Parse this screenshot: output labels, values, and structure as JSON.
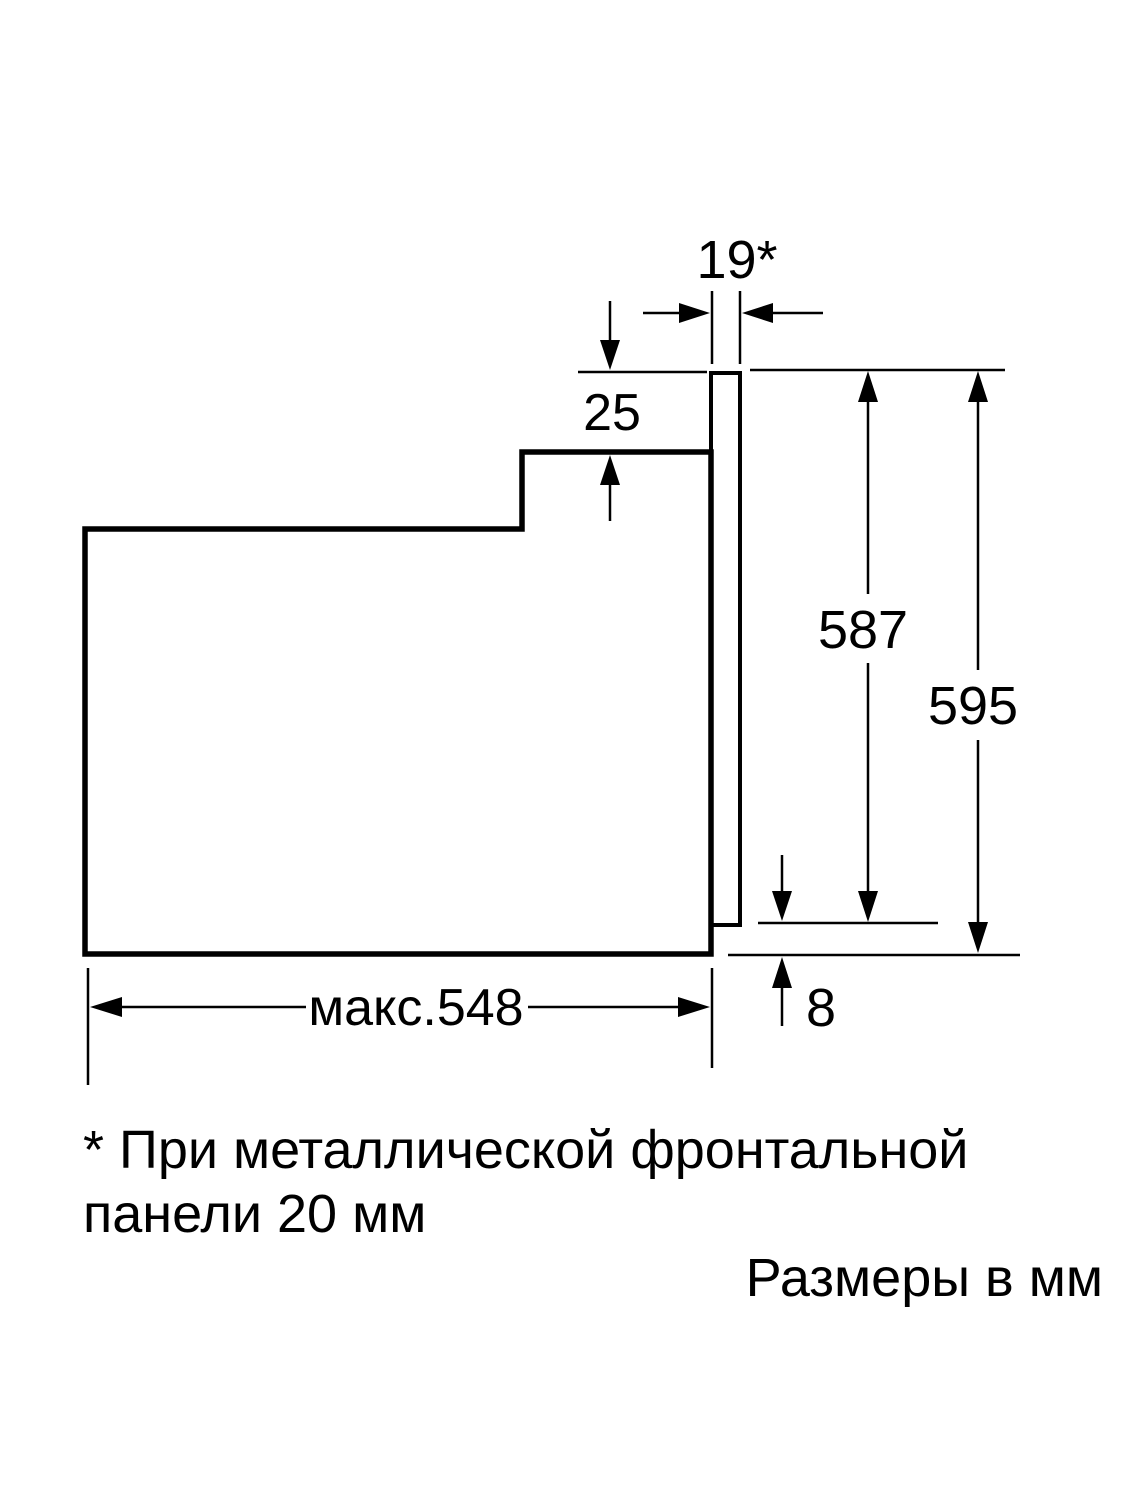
{
  "page": {
    "background_color": "#ffffff",
    "line_color": "#000000"
  },
  "diagram": {
    "type": "appliance-installation-drawing",
    "units_label": "Размеры в мм",
    "footnote": {
      "line1": "* При металлической фронтальной",
      "line2": "панели 20 мм"
    },
    "dimensions": {
      "front_panel_thickness": "19*",
      "top_recess": "25",
      "body_height": "587",
      "overall_height": "595",
      "bottom_offset": "8",
      "max_depth": "макс.548"
    }
  }
}
